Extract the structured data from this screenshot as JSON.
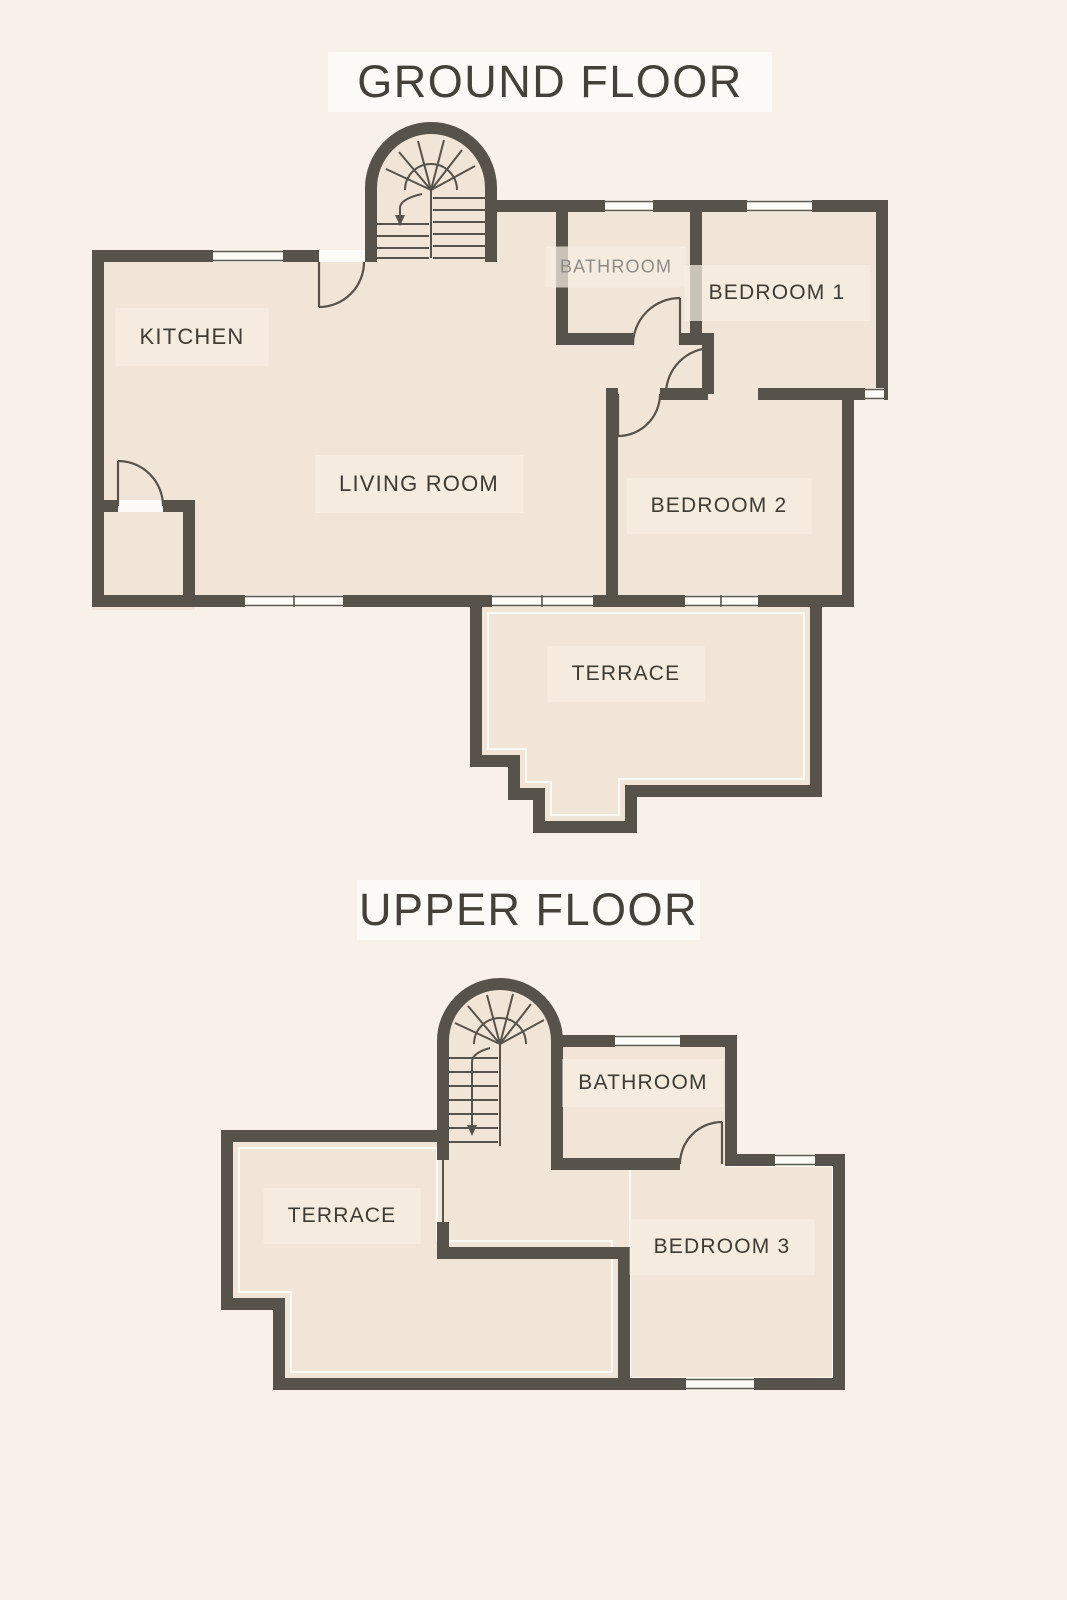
{
  "palette": {
    "background": "#f8f1ea",
    "floor": "#f1e5d8",
    "wall": "#57524a",
    "window_white": "#fdfbf7",
    "label_dark": "#3e3a34",
    "label_muted": "#8d8b88",
    "title_band": "#fcfaf6"
  },
  "floors": [
    {
      "id": "ground",
      "title": "GROUND FLOOR",
      "rooms": [
        {
          "key": "kitchen",
          "label": "KITCHEN"
        },
        {
          "key": "living-room",
          "label": "LIVING ROOM"
        },
        {
          "key": "bathroom",
          "label": "BATHROOM"
        },
        {
          "key": "bedroom-1",
          "label": "BEDROOM 1"
        },
        {
          "key": "bedroom-2",
          "label": "BEDROOM 2"
        },
        {
          "key": "terrace",
          "label": "TERRACE"
        }
      ]
    },
    {
      "id": "upper",
      "title": "UPPER FLOOR",
      "rooms": [
        {
          "key": "bathroom",
          "label": "BATHROOM"
        },
        {
          "key": "terrace",
          "label": "TERRACE"
        },
        {
          "key": "bedroom-3",
          "label": "BEDROOM 3"
        }
      ]
    }
  ]
}
